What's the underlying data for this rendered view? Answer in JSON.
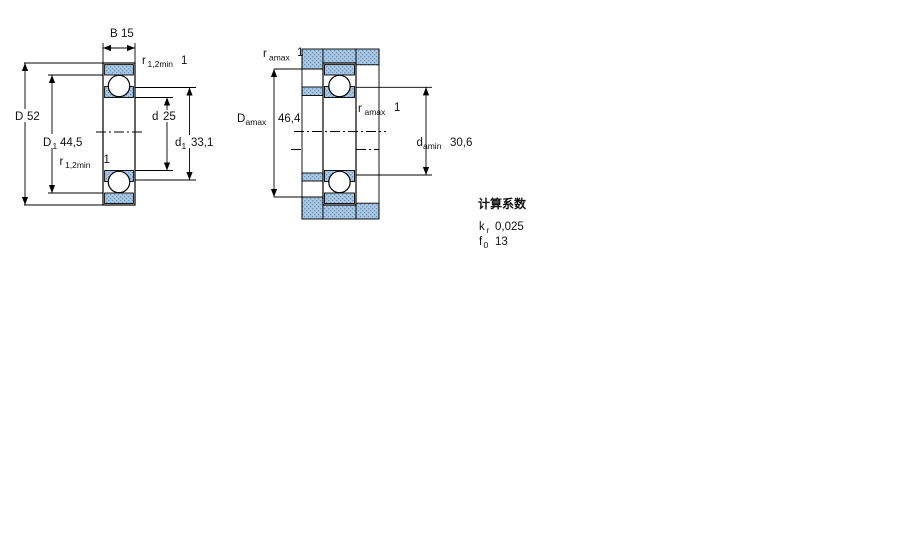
{
  "figure1": {
    "dim_B": {
      "sym": "B",
      "value": "15"
    },
    "dim_r_top": {
      "sym": "r",
      "sub": "1,2min",
      "value": "1"
    },
    "dim_D": {
      "sym": "D",
      "value": "52"
    },
    "dim_D1": {
      "sym": "D",
      "sub": "1",
      "value": "44,5"
    },
    "dim_r_bottom": {
      "sym": "r",
      "sub": "1,2min",
      "value": "1"
    },
    "dim_d": {
      "sym": "d",
      "value": "25"
    },
    "dim_d1": {
      "sym": "d",
      "sub": "1",
      "value": "33,1"
    }
  },
  "figure2": {
    "dim_ra_top": {
      "sym": "r",
      "sub": "amax",
      "value": "1"
    },
    "dim_Damax": {
      "sym": "D",
      "sub": "amax",
      "value": "46,4"
    },
    "dim_ra_mid": {
      "sym": "r",
      "sub": "amax",
      "value": "1"
    },
    "dim_damin": {
      "sym": "d",
      "sub": "amin",
      "value": "30,6"
    }
  },
  "factors": {
    "title": "计算系数",
    "rows": [
      {
        "sym": "k",
        "sub": "r",
        "value": "0,025"
      },
      {
        "sym": "f",
        "sub": "0",
        "value": "13"
      }
    ]
  },
  "colors": {
    "background": "#ffffff",
    "line": "#000000",
    "hatch_base": "#abc8e2",
    "hatch_dot": "#6f93b8"
  }
}
